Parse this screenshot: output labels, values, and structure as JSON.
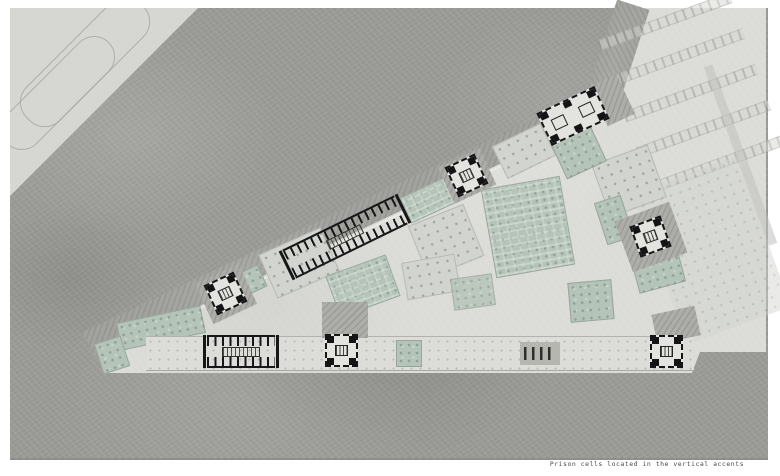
{
  "document": {
    "type": "architectural-site-plan",
    "caption": "Prison cells located in the vertical accents"
  },
  "palette": {
    "page_background": "#ffffff",
    "terrain_dark": "#9a9a96",
    "site_light": "#dbdbd7",
    "perimeter_road_band": "#a2a29e",
    "upper_road": "#d6d6d2",
    "courtyard_green": "#b5c4b8",
    "orchard_ground": "#d2d5cf",
    "building_ink": "#161616",
    "caption_text": "#4a4a4a"
  },
  "features": [
    "perimeter-road-band",
    "parking-lot",
    "linear-cell-block",
    "cell-tower-vertical-accent",
    "administration-building",
    "green-courtyard",
    "orchard-courtyard",
    "service-strip",
    "entry-gate"
  ]
}
